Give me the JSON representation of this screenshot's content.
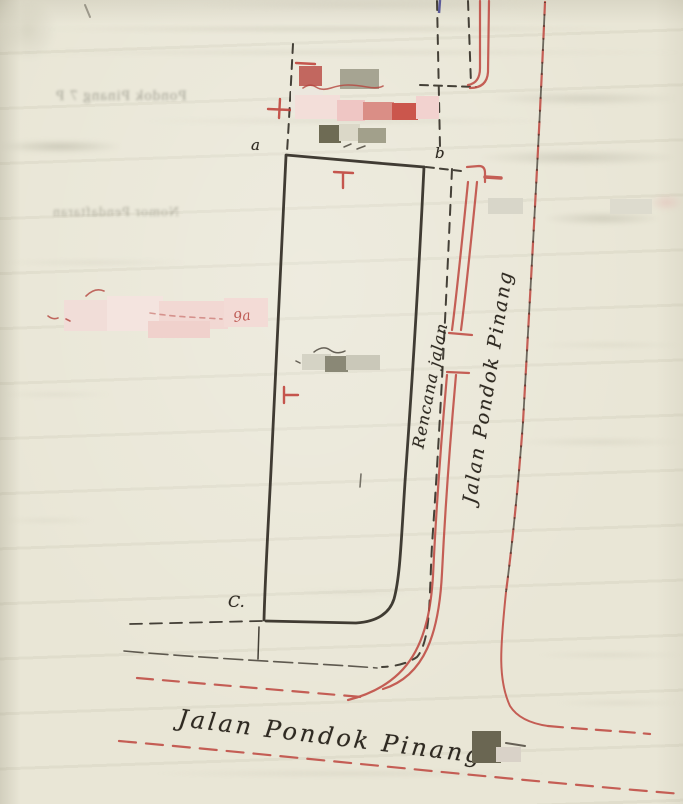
{
  "labels": {
    "corner_a": "a",
    "corner_b": "b",
    "corner_c": "C.",
    "planned_road": "Rencana jalan",
    "road_side": "Jalan Pondok Pinang",
    "road_bottom": "Jalan Pondok Pinang",
    "red_remnant": "9a"
  },
  "ghost_text": {
    "registration": "Nomor Pendaftaran",
    "top_line": "Pondok Pinang 7 P"
  },
  "colors": {
    "paper": "#e9e6d6",
    "ink_black": "#2e2921",
    "ink_red": "#bf4a42",
    "ink_blue": "#5a5a99",
    "ghost": "#8b897a"
  },
  "redactions": [
    {
      "x": 299,
      "y": 66,
      "w": 23,
      "h": 20,
      "c": "#c2675f"
    },
    {
      "x": 340,
      "y": 69,
      "w": 39,
      "h": 20,
      "c": "#a6a492"
    },
    {
      "x": 291,
      "y": 89,
      "w": 32,
      "h": 24,
      "c": "#ece7de"
    },
    {
      "x": 295,
      "y": 95,
      "w": 45,
      "h": 24,
      "c": "#f3ded9"
    },
    {
      "x": 337,
      "y": 100,
      "w": 28,
      "h": 21,
      "c": "#efc6c4"
    },
    {
      "x": 363,
      "y": 102,
      "w": 31,
      "h": 18,
      "c": "#da8e86"
    },
    {
      "x": 392,
      "y": 103,
      "w": 26,
      "h": 17,
      "c": "#cb564c"
    },
    {
      "x": 416,
      "y": 96,
      "w": 23,
      "h": 23,
      "c": "#f2d2cf"
    },
    {
      "x": 319,
      "y": 125,
      "w": 22,
      "h": 18,
      "c": "#6e6b54"
    },
    {
      "x": 339,
      "y": 124,
      "w": 21,
      "h": 17,
      "c": "#dbd8c8"
    },
    {
      "x": 358,
      "y": 128,
      "w": 28,
      "h": 15,
      "c": "#a2a08b"
    },
    {
      "x": 64,
      "y": 300,
      "w": 46,
      "h": 31,
      "c": "#f1ddd8"
    },
    {
      "x": 107,
      "y": 296,
      "w": 56,
      "h": 35,
      "c": "#f4e4df"
    },
    {
      "x": 159,
      "y": 301,
      "w": 69,
      "h": 28,
      "c": "#f2d8d3"
    },
    {
      "x": 224,
      "y": 298,
      "w": 44,
      "h": 29,
      "c": "#f3dbd6"
    },
    {
      "x": 148,
      "y": 321,
      "w": 62,
      "h": 17,
      "c": "#f0d1cc"
    },
    {
      "x": 302,
      "y": 354,
      "w": 29,
      "h": 16,
      "c": "#d5d3c5"
    },
    {
      "x": 325,
      "y": 356,
      "w": 23,
      "h": 16,
      "c": "#8a8876"
    },
    {
      "x": 346,
      "y": 355,
      "w": 34,
      "h": 15,
      "c": "#cac8b9"
    },
    {
      "x": 488,
      "y": 198,
      "w": 35,
      "h": 16,
      "c": "#d8d6c9"
    },
    {
      "x": 610,
      "y": 199,
      "w": 42,
      "h": 15,
      "c": "#dddbce"
    },
    {
      "x": 472,
      "y": 731,
      "w": 29,
      "h": 32,
      "c": "#6a6652"
    },
    {
      "x": 496,
      "y": 747,
      "w": 25,
      "h": 15,
      "c": "#d9d2c8"
    }
  ],
  "streaks": [
    {
      "x": 40,
      "y": 26,
      "w": 580,
      "h": 6,
      "o": 0.45,
      "c": "#b9b6a2"
    },
    {
      "x": 0,
      "y": 50,
      "w": 683,
      "h": 5,
      "o": 0.35,
      "c": "#bcb9a6"
    },
    {
      "x": 140,
      "y": 118,
      "w": 420,
      "h": 6,
      "o": 0.3,
      "c": "#bdbaa8"
    },
    {
      "x": 0,
      "y": 140,
      "w": 120,
      "h": 13,
      "o": 0.5,
      "c": "#aeac9a"
    },
    {
      "x": 480,
      "y": 150,
      "w": 195,
      "h": 15,
      "o": 0.45,
      "c": "#b3b1a0"
    },
    {
      "x": 492,
      "y": 92,
      "w": 185,
      "h": 13,
      "o": 0.4,
      "c": "#b6b4a3"
    },
    {
      "x": 545,
      "y": 212,
      "w": 115,
      "h": 13,
      "o": 0.45,
      "c": "#b2b09e"
    },
    {
      "x": 0,
      "y": 260,
      "w": 190,
      "h": 5,
      "o": 0.3,
      "c": "#bebba9"
    },
    {
      "x": 536,
      "y": 342,
      "w": 147,
      "h": 6,
      "o": 0.3,
      "c": "#c0bdab"
    },
    {
      "x": 0,
      "y": 392,
      "w": 110,
      "h": 5,
      "o": 0.28,
      "c": "#c0bdab"
    },
    {
      "x": 516,
      "y": 438,
      "w": 167,
      "h": 8,
      "o": 0.3,
      "c": "#bdbaa8"
    },
    {
      "x": 0,
      "y": 518,
      "w": 95,
      "h": 5,
      "o": 0.28,
      "c": "#c0bdab"
    },
    {
      "x": 290,
      "y": 590,
      "w": 130,
      "h": 5,
      "o": 0.25,
      "c": "#c1bead"
    },
    {
      "x": 536,
      "y": 652,
      "w": 147,
      "h": 6,
      "o": 0.3,
      "c": "#bebba9"
    },
    {
      "x": 150,
      "y": 770,
      "w": 400,
      "h": 7,
      "o": 0.3,
      "c": "#bcb9a7"
    },
    {
      "x": 556,
      "y": 700,
      "w": 127,
      "h": 6,
      "o": 0.28,
      "c": "#bfbcaa"
    },
    {
      "x": 650,
      "y": 194,
      "w": 33,
      "h": 17,
      "o": 0.5,
      "c": "#e3b9b4"
    },
    {
      "x": 150,
      "y": 326,
      "w": 40,
      "h": 10,
      "o": 0.4,
      "c": "#e8c4bf"
    },
    {
      "x": 0,
      "y": 0,
      "w": 55,
      "h": 60,
      "o": 0.25,
      "c": "#a8a590"
    },
    {
      "x": 200,
      "y": 0,
      "w": 340,
      "h": 10,
      "o": 0.3,
      "c": "#c6c3b2"
    }
  ]
}
